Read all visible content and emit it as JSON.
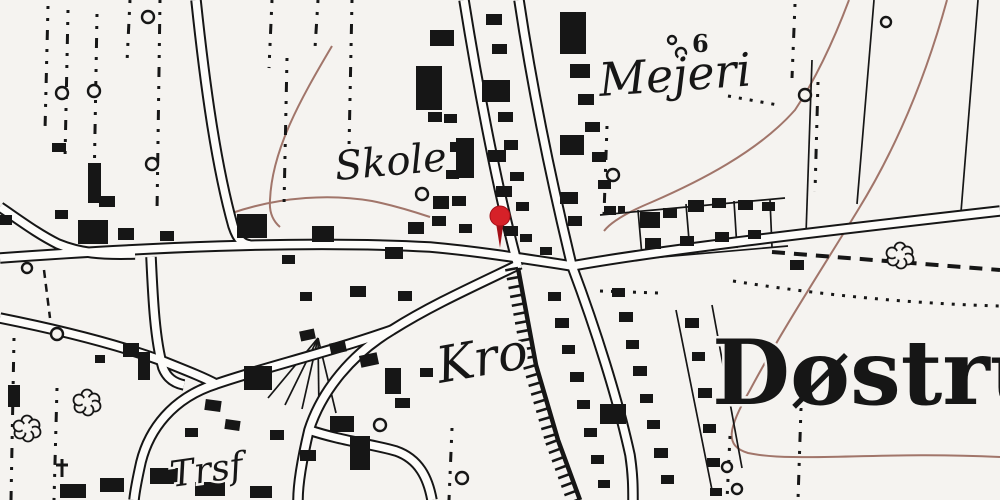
{
  "map": {
    "type": "historical-topographic-map",
    "place_labels": {
      "mejeri": "Mejeri",
      "skole": "Skole",
      "kro": "Kro",
      "trsf": "Trsf",
      "dostrup": "Døstru",
      "elevation": "6"
    },
    "colors": {
      "paper": "#f5f3f0",
      "ink": "#161616",
      "road_fill": "#fdfcfa",
      "contour": "#a1756a",
      "pin": "#d62128",
      "pin_dark": "#a31018"
    },
    "labels": [
      {
        "id": "mejeri",
        "text": "Mejeri",
        "x": 600,
        "y": 96,
        "size": 46,
        "style": "italic",
        "weight": "normal",
        "rotate": -4
      },
      {
        "id": "skole",
        "text": "Skole",
        "x": 336,
        "y": 180,
        "size": 40,
        "style": "italic",
        "weight": "normal",
        "rotate": -5
      },
      {
        "id": "kro",
        "text": "Kro",
        "x": 440,
        "y": 383,
        "size": 50,
        "style": "italic",
        "weight": "normal",
        "rotate": -10
      },
      {
        "id": "trsf",
        "text": "Trsf",
        "x": 172,
        "y": 487,
        "size": 36,
        "style": "italic",
        "weight": "normal",
        "rotate": -8
      },
      {
        "id": "dostrup",
        "text": "Døstru",
        "x": 712,
        "y": 404,
        "size": 90,
        "style": "normal",
        "weight": "bold",
        "rotate": 0
      },
      {
        "id": "elevation-6",
        "text": "6",
        "x": 692,
        "y": 52,
        "size": 24,
        "style": "normal",
        "weight": "bold",
        "rotate": 0
      }
    ],
    "pin": {
      "x": 500,
      "y": 216,
      "r": 10,
      "stem_bottom": 248
    },
    "roads": [
      {
        "id": "west-main-road",
        "d": "M 0 258 C 140 248 300 240 430 247 C 475 251 520 258 572 266"
      },
      {
        "id": "east-main-road",
        "d": "M 572 266 C 650 252 780 236 1000 211"
      },
      {
        "id": "northwest-lane",
        "d": "M 0 207 C 22 222 38 234 58 244 C 80 253 100 255 135 254"
      },
      {
        "id": "north-road",
        "d": "M 196 0 C 205 85 216 165 233 226 C 238 241 243 244 250 245"
      },
      {
        "id": "main-street",
        "d": "M 519 0 C 534 100 556 200 572 266"
      },
      {
        "id": "station-rail-band",
        "d": "M 464 0 C 480 100 500 200 518 266"
      },
      {
        "id": "southeast-road",
        "d": "M 572 266 C 596 330 618 400 630 455 C 633 475 633 488 633 500"
      },
      {
        "id": "kro-road",
        "d": "M 520 264 C 470 288 430 306 392 330 C 352 354 322 390 309 430 C 301 464 298 484 298 500"
      },
      {
        "id": "trsf-road",
        "d": "M 392 330 C 330 352 262 368 216 384 C 172 398 149 430 141 462 C 137 480 135 490 134 500"
      },
      {
        "id": "west-leg-road",
        "d": "M 0 318 C 60 330 120 345 165 362 C 190 372 205 378 216 384"
      },
      {
        "id": "south-branch",
        "d": "M 309 430 C 342 441 372 444 396 451 C 419 459 428 478 432 500"
      },
      {
        "id": "village-lane",
        "d": "M 151 257 C 153 300 155 340 163 368 C 167 378 174 383 184 385"
      }
    ],
    "railway": {
      "points": [
        [
          518,
          268
        ],
        [
          536,
          365
        ],
        [
          558,
          440
        ],
        [
          580,
          500
        ]
      ],
      "tie_len": 13,
      "tie_step": 9
    },
    "contours": [
      "M 332 46 C 300 100 272 150 270 200 C 269 212 273 221 280 227",
      "M 232 213 C 282 196 332 194 372 201 C 392 205 412 211 430 217",
      "M 849 0 C 832 45 815 80 795 110 C 758 152 698 182 652 202 C 628 212 611 222 604 231",
      "M 947 0 C 925 80 895 150 858 210 C 820 272 782 330 750 390 C 728 428 724 446 748 453 C 795 463 880 451 1000 457"
    ],
    "dotdash_columns": [
      [
        48,
        6,
        130
      ],
      [
        68,
        10,
        158
      ],
      [
        97,
        14,
        190
      ],
      [
        130,
        0,
        62
      ],
      [
        160,
        0,
        212
      ],
      [
        272,
        0,
        68
      ],
      [
        287,
        58,
        205
      ],
      [
        318,
        0,
        48
      ],
      [
        352,
        0,
        148
      ],
      [
        607,
        126,
        214
      ],
      [
        795,
        4,
        78
      ],
      [
        818,
        82,
        192
      ],
      [
        801,
        408,
        500
      ],
      [
        730,
        436,
        500
      ],
      [
        452,
        428,
        500
      ],
      [
        14,
        338,
        500
      ],
      [
        57,
        388,
        500
      ]
    ],
    "dotted_lines": [
      "M 733 281 C 840 298 930 304 1000 306",
      "M 600 291 L 658 293",
      "M 728 96 L 778 105"
    ],
    "dashed_lines": [
      {
        "d": "M 58 252 L 205 248",
        "w": 2.5,
        "dash": "10 7"
      },
      {
        "d": "M 772 252 L 1000 270",
        "w": 4,
        "dash": "13 9"
      },
      {
        "d": "M 44 270 L 50 318",
        "w": 2.5,
        "dash": "8 6"
      }
    ],
    "fences": [
      "M 874 0 L 857 204",
      "M 978 0 L 961 212",
      "M 812 60 L 806 234",
      "M 600 215 L 785 198",
      "M 604 262 L 788 246",
      "M 638 210 L 642 256",
      "M 686 204 L 690 252",
      "M 734 201 L 737 248",
      "M 770 200 L 772 247",
      "M 676 310 L 712 490",
      "M 712 305 L 742 468",
      "M 318 338 L 268 398",
      "M 318 338 L 285 405",
      "M 318 338 L 302 409",
      "M 318 338 L 319 412",
      "M 318 338 L 336 413"
    ],
    "circles": [
      [
        62,
        93,
        6
      ],
      [
        94,
        91,
        6
      ],
      [
        148,
        17,
        6
      ],
      [
        152,
        164,
        6
      ],
      [
        422,
        194,
        6
      ],
      [
        27,
        268,
        5
      ],
      [
        380,
        425,
        6
      ],
      [
        462,
        478,
        6
      ],
      [
        613,
        175,
        6
      ],
      [
        805,
        95,
        6
      ],
      [
        886,
        22,
        5
      ],
      [
        672,
        40,
        4
      ],
      [
        681,
        53,
        5
      ],
      [
        727,
        467,
        5
      ],
      [
        737,
        489,
        5
      ],
      [
        57,
        334,
        6
      ]
    ],
    "trees": [
      [
        900,
        255
      ],
      [
        87,
        402
      ],
      [
        27,
        428
      ]
    ],
    "crosses": [
      [
        62,
        468
      ]
    ],
    "buildings": [
      [
        88,
        163,
        13,
        40
      ],
      [
        99,
        196,
        16,
        11
      ],
      [
        52,
        143,
        14,
        9
      ],
      [
        78,
        220,
        30,
        24
      ],
      [
        118,
        228,
        16,
        12
      ],
      [
        160,
        231,
        14,
        10
      ],
      [
        0,
        215,
        12,
        10
      ],
      [
        55,
        210,
        13,
        9
      ],
      [
        237,
        214,
        30,
        24
      ],
      [
        312,
        226,
        22,
        16
      ],
      [
        385,
        247,
        18,
        12
      ],
      [
        350,
        286,
        16,
        11
      ],
      [
        398,
        291,
        14,
        10
      ],
      [
        300,
        292,
        12,
        9
      ],
      [
        408,
        222,
        16,
        12
      ],
      [
        432,
        216,
        14,
        10
      ],
      [
        456,
        138,
        18,
        40
      ],
      [
        433,
        196,
        16,
        13
      ],
      [
        282,
        255,
        13,
        9
      ],
      [
        416,
        66,
        26,
        44
      ],
      [
        430,
        30,
        24,
        16
      ],
      [
        428,
        112,
        14,
        10
      ],
      [
        444,
        114,
        13,
        9
      ],
      [
        450,
        142,
        14,
        10
      ],
      [
        446,
        170,
        13,
        9
      ],
      [
        452,
        196,
        14,
        10
      ],
      [
        459,
        224,
        13,
        9
      ],
      [
        486,
        14,
        16,
        11
      ],
      [
        492,
        44,
        15,
        10
      ],
      [
        482,
        80,
        28,
        22
      ],
      [
        498,
        112,
        15,
        10
      ],
      [
        488,
        150,
        18,
        12
      ],
      [
        504,
        140,
        14,
        10
      ],
      [
        510,
        172,
        14,
        9
      ],
      [
        496,
        186,
        16,
        11
      ],
      [
        516,
        202,
        13,
        9
      ],
      [
        504,
        226,
        14,
        10
      ],
      [
        520,
        234,
        12,
        8
      ],
      [
        560,
        12,
        26,
        42
      ],
      [
        570,
        64,
        20,
        14
      ],
      [
        578,
        94,
        16,
        11
      ],
      [
        560,
        135,
        24,
        20
      ],
      [
        585,
        122,
        15,
        10
      ],
      [
        592,
        152,
        14,
        10
      ],
      [
        560,
        192,
        18,
        12
      ],
      [
        598,
        180,
        13,
        9
      ],
      [
        604,
        206,
        12,
        8
      ],
      [
        568,
        216,
        14,
        10
      ],
      [
        540,
        247,
        12,
        8
      ],
      [
        640,
        212,
        20,
        16
      ],
      [
        663,
        208,
        14,
        10
      ],
      [
        688,
        200,
        16,
        12
      ],
      [
        712,
        198,
        14,
        10
      ],
      [
        738,
        200,
        15,
        10
      ],
      [
        762,
        202,
        13,
        9
      ],
      [
        645,
        238,
        16,
        11
      ],
      [
        680,
        236,
        14,
        10
      ],
      [
        715,
        232,
        14,
        10
      ],
      [
        748,
        230,
        13,
        9
      ],
      [
        790,
        260,
        14,
        10
      ],
      [
        609,
        208,
        7,
        7
      ],
      [
        618,
        206,
        7,
        7
      ],
      [
        548,
        292,
        13,
        9
      ],
      [
        555,
        318,
        14,
        10
      ],
      [
        562,
        345,
        13,
        9
      ],
      [
        570,
        372,
        14,
        10
      ],
      [
        577,
        400,
        13,
        9
      ],
      [
        584,
        428,
        13,
        9
      ],
      [
        591,
        455,
        13,
        9
      ],
      [
        598,
        480,
        12,
        8
      ],
      [
        612,
        288,
        13,
        9
      ],
      [
        619,
        312,
        14,
        10
      ],
      [
        626,
        340,
        13,
        9
      ],
      [
        633,
        366,
        14,
        10
      ],
      [
        640,
        394,
        13,
        9
      ],
      [
        647,
        420,
        13,
        9
      ],
      [
        654,
        448,
        14,
        10
      ],
      [
        661,
        475,
        13,
        9
      ],
      [
        685,
        318,
        14,
        10
      ],
      [
        692,
        352,
        13,
        9
      ],
      [
        698,
        388,
        14,
        10
      ],
      [
        703,
        424,
        13,
        9
      ],
      [
        707,
        458,
        13,
        9
      ],
      [
        710,
        488,
        12,
        8
      ],
      [
        600,
        404,
        26,
        20
      ],
      [
        244,
        366,
        28,
        24
      ],
      [
        300,
        330,
        15,
        10,
        -12
      ],
      [
        330,
        342,
        16,
        11,
        -12
      ],
      [
        360,
        354,
        18,
        12,
        -12
      ],
      [
        385,
        368,
        16,
        26
      ],
      [
        395,
        398,
        15,
        10
      ],
      [
        330,
        416,
        24,
        16
      ],
      [
        350,
        436,
        20,
        34
      ],
      [
        300,
        450,
        16,
        11
      ],
      [
        270,
        430,
        14,
        10
      ],
      [
        205,
        400,
        16,
        11,
        8
      ],
      [
        225,
        420,
        15,
        10,
        8
      ],
      [
        185,
        428,
        13,
        9
      ],
      [
        150,
        468,
        28,
        16
      ],
      [
        100,
        478,
        24,
        14
      ],
      [
        195,
        482,
        30,
        14
      ],
      [
        250,
        486,
        22,
        12
      ],
      [
        60,
        484,
        26,
        14
      ],
      [
        420,
        368,
        13,
        9
      ],
      [
        8,
        385,
        12,
        22
      ],
      [
        123,
        343,
        16,
        14
      ],
      [
        138,
        352,
        12,
        28
      ],
      [
        95,
        355,
        10,
        8
      ]
    ]
  }
}
